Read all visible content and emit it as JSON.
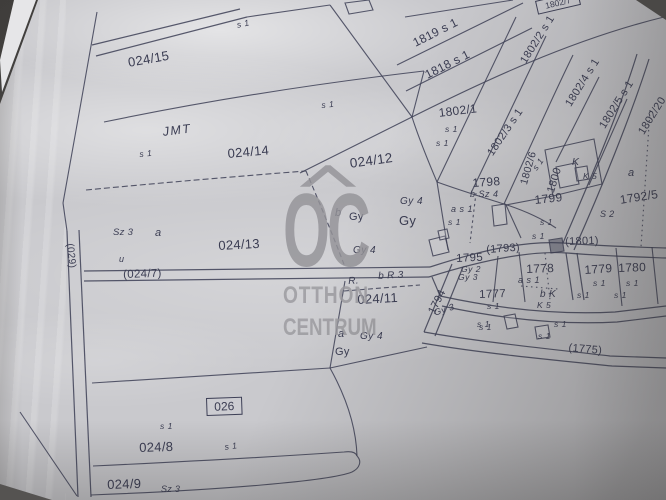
{
  "colors": {
    "paper": "#c9c9cd",
    "ink": "#3d3f56",
    "watermark": "#97969a"
  },
  "watermark": {
    "initials": "OC",
    "line1": "OTTHON",
    "line2": "CENTRUM"
  },
  "labels": {
    "p024_15": "024/15",
    "p024_14": "024/14",
    "p024_13": "024/13",
    "p024_12": "024/12",
    "p024_11": "024/11",
    "p024_9": "024/9",
    "p024_8": "024/8",
    "p024_7": "(024/7)",
    "p026": "026",
    "p029": "(029)",
    "jmt": "JMT",
    "s1": "s 1",
    "sz3": "Sz 3",
    "a": "a",
    "b": "b",
    "gy": "Gy",
    "gy2": "Gy 2",
    "gy3": "Gy 3",
    "gy4": "Gy 4",
    "r": "R.",
    "br3": "b R 3",
    "as1": "a s 1",
    "bsz4": "b Sz 4",
    "bk": "b K",
    "k": "K",
    "k5": "K 5",
    "s2": "S 2",
    "u_mark": "u",
    "p1819": "1819 s 1",
    "p1818": "1818 s 1",
    "p1802_1": "1802/1",
    "p1802_2": "1802/2 s 1",
    "p1802_3": "1802/3 s 1",
    "p1802_4": "1802/4 s 1",
    "p1802_5": "1802/5 s 1",
    "p1802_20": "1802/20",
    "p1802_6": "1802/6",
    "p1802_7": "1802/7",
    "p1800": "1800",
    "p1798": "1798",
    "p1799": "1799",
    "p1801": "(1801)",
    "p1793": "(1793)",
    "p1795": "1795",
    "p1794": "1794",
    "p1775": "(1775)",
    "p1777": "1777",
    "p1778": "1778",
    "p1779": "1779",
    "p1780": "1780",
    "p1792_5": "1792/5"
  }
}
